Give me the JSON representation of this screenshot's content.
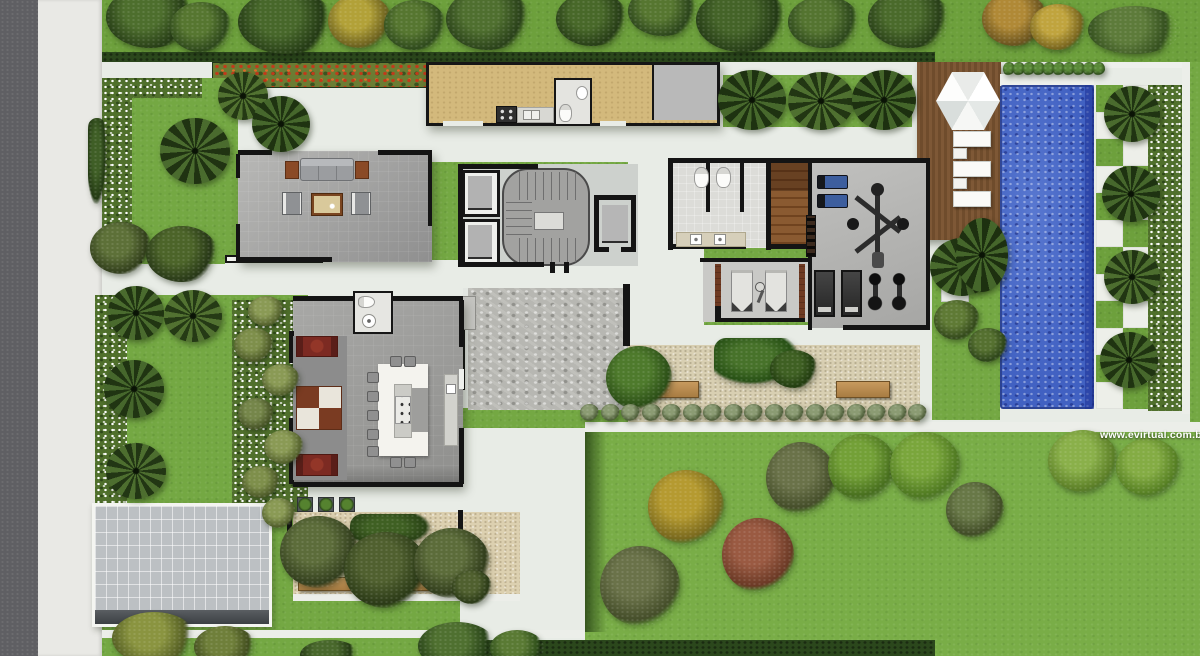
{
  "watermark": {
    "text": "www.evirtual.com.br",
    "color": "#ffffff"
  },
  "palette": {
    "grass": "#74a843",
    "grass_outer": "#6da03c",
    "street_asphalt": "#5f5f63",
    "sidewalk": "#e9e9e5",
    "walkway_white": "#e8ece6",
    "hedge": "#2b471c",
    "flower_red": "#c23a1a",
    "kitchen_floor": "#d3b97c",
    "deck_wood": "#7e5836",
    "sauna_wood": "#8a5a31",
    "pool_water": "#4161c2",
    "pool_deep_edge": "#2c49a4",
    "water_feature_gray": "#b7b7b2",
    "gravel": "#d8cfb2",
    "courtyard_sand": "#dcd0b0",
    "driveway": "#bcc0c3",
    "wall_black": "#141414",
    "sofa_red": "#7c2a22",
    "gym_bench_blue": "#3d5e9e",
    "bench_wood": "#b98b4e",
    "table_white": "#f4f3ee"
  },
  "scene": {
    "trees": [
      {
        "k": "round",
        "x": 106,
        "y": -14,
        "w": 88,
        "h": 62,
        "c1": "#4d6e2d",
        "c2": "#263c16"
      },
      {
        "k": "round",
        "x": 170,
        "y": 2,
        "w": 62,
        "h": 50,
        "c1": "#567630",
        "c2": "#2e481c"
      },
      {
        "k": "round",
        "x": 238,
        "y": -10,
        "w": 96,
        "h": 64,
        "c1": "#47672a",
        "c2": "#243a15"
      },
      {
        "k": "round",
        "x": 328,
        "y": -6,
        "w": 64,
        "h": 54,
        "c1": "#b2a138",
        "c2": "#6d6220"
      },
      {
        "k": "round",
        "x": 384,
        "y": 0,
        "w": 62,
        "h": 50,
        "c1": "#567630",
        "c2": "#2f4a1d"
      },
      {
        "k": "round",
        "x": 446,
        "y": -12,
        "w": 84,
        "h": 62,
        "c1": "#4f6f2f",
        "c2": "#2a411a"
      },
      {
        "k": "round",
        "x": 556,
        "y": -8,
        "w": 72,
        "h": 54,
        "c1": "#486829",
        "c2": "#273d17"
      },
      {
        "k": "round",
        "x": 628,
        "y": -14,
        "w": 70,
        "h": 50,
        "c1": "#567630",
        "c2": "#2c451c"
      },
      {
        "k": "round",
        "x": 696,
        "y": -12,
        "w": 92,
        "h": 64,
        "c1": "#446328",
        "c2": "#243a16"
      },
      {
        "k": "round",
        "x": 788,
        "y": -4,
        "w": 72,
        "h": 52,
        "c1": "#547430",
        "c2": "#2d471c"
      },
      {
        "k": "round",
        "x": 868,
        "y": -10,
        "w": 82,
        "h": 58,
        "c1": "#4a6a2b",
        "c2": "#283e18"
      },
      {
        "k": "round",
        "x": 982,
        "y": -8,
        "w": 66,
        "h": 54,
        "c1": "#b08936",
        "c2": "#6a5420"
      },
      {
        "k": "round",
        "x": 1030,
        "y": 4,
        "w": 56,
        "h": 46,
        "c1": "#c0a43e",
        "c2": "#78651f"
      },
      {
        "k": "round",
        "x": 1088,
        "y": 6,
        "w": 92,
        "h": 48,
        "c1": "#5d7b3a",
        "c2": "#35501f"
      },
      {
        "k": "palm",
        "x": 160,
        "y": 118,
        "w": 70,
        "h": 66,
        "c1": "#4a6b2e",
        "c2": "#203312"
      },
      {
        "k": "palm",
        "x": 218,
        "y": 72,
        "w": 50,
        "h": 48,
        "c1": "#527231",
        "c2": "#243914"
      },
      {
        "k": "palm",
        "x": 252,
        "y": 96,
        "w": 58,
        "h": 56,
        "c1": "#46672c",
        "c2": "#1f3311"
      },
      {
        "k": "hedge",
        "x": 88,
        "y": 118,
        "w": 18,
        "h": 86,
        "c1": "#3f5e26",
        "c2": "#243a14"
      },
      {
        "k": "round",
        "x": 90,
        "y": 222,
        "w": 62,
        "h": 52,
        "c1": "#5d7038",
        "c2": "#323f1c"
      },
      {
        "k": "round",
        "x": 146,
        "y": 226,
        "w": 72,
        "h": 56,
        "c1": "#4c6429",
        "c2": "#273717"
      },
      {
        "k": "palm",
        "x": 108,
        "y": 286,
        "w": 56,
        "h": 54,
        "c1": "#4a6b2e",
        "c2": "#213512"
      },
      {
        "k": "palm",
        "x": 164,
        "y": 290,
        "w": 58,
        "h": 52,
        "c1": "#527231",
        "c2": "#253a15"
      },
      {
        "k": "palm",
        "x": 104,
        "y": 360,
        "w": 60,
        "h": 58,
        "c1": "#46672c",
        "c2": "#203412"
      },
      {
        "k": "palm",
        "x": 106,
        "y": 443,
        "w": 60,
        "h": 56,
        "c1": "#4d6e2f",
        "c2": "#223614"
      },
      {
        "k": "round",
        "x": 248,
        "y": 296,
        "w": 36,
        "h": 30,
        "c1": "#8a9a55",
        "c2": "#55622e"
      },
      {
        "k": "round",
        "x": 234,
        "y": 328,
        "w": 40,
        "h": 34,
        "c1": "#7e8f4b",
        "c2": "#4c5928"
      },
      {
        "k": "round",
        "x": 262,
        "y": 364,
        "w": 38,
        "h": 32,
        "c1": "#8a9a55",
        "c2": "#515e2c"
      },
      {
        "k": "round",
        "x": 238,
        "y": 398,
        "w": 36,
        "h": 32,
        "c1": "#75864a",
        "c2": "#475427"
      },
      {
        "k": "round",
        "x": 264,
        "y": 430,
        "w": 40,
        "h": 34,
        "c1": "#8a9a55",
        "c2": "#55622e"
      },
      {
        "k": "round",
        "x": 242,
        "y": 466,
        "w": 38,
        "h": 32,
        "c1": "#7e8f4b",
        "c2": "#4c5928"
      },
      {
        "k": "round",
        "x": 262,
        "y": 498,
        "w": 34,
        "h": 30,
        "c1": "#8a9a55",
        "c2": "#515e2c"
      },
      {
        "k": "palm",
        "x": 718,
        "y": 70,
        "w": 68,
        "h": 60,
        "c1": "#47682c",
        "c2": "#1e3211"
      },
      {
        "k": "palm",
        "x": 788,
        "y": 72,
        "w": 66,
        "h": 58,
        "c1": "#4f7030",
        "c2": "#223613"
      },
      {
        "k": "palm",
        "x": 852,
        "y": 70,
        "w": 64,
        "h": 60,
        "c1": "#44652a",
        "c2": "#1d3010"
      },
      {
        "k": "palm",
        "x": 930,
        "y": 238,
        "w": 64,
        "h": 58,
        "c1": "#496a2d",
        "c2": "#203412"
      },
      {
        "k": "round",
        "x": 934,
        "y": 300,
        "w": 46,
        "h": 40,
        "c1": "#5f7a35",
        "c2": "#34491c"
      },
      {
        "k": "round",
        "x": 968,
        "y": 328,
        "w": 40,
        "h": 34,
        "c1": "#557030",
        "c2": "#2d441a"
      },
      {
        "k": "palm",
        "x": 956,
        "y": 218,
        "w": 52,
        "h": 74,
        "c1": "#45662b",
        "c2": "#1d3010"
      },
      {
        "k": "palm",
        "x": 1104,
        "y": 86,
        "w": 56,
        "h": 56,
        "c1": "#4a6b2e",
        "c2": "#203412"
      },
      {
        "k": "palm",
        "x": 1102,
        "y": 166,
        "w": 58,
        "h": 56,
        "c1": "#46672c",
        "c2": "#1e3211"
      },
      {
        "k": "palm",
        "x": 1104,
        "y": 250,
        "w": 56,
        "h": 54,
        "c1": "#4d6e2f",
        "c2": "#213513"
      },
      {
        "k": "palm",
        "x": 1100,
        "y": 332,
        "w": 58,
        "h": 56,
        "c1": "#47682c",
        "c2": "#1f3311"
      },
      {
        "k": "hedge",
        "x": 350,
        "y": 514,
        "w": 80,
        "h": 32,
        "c1": "#3f6023",
        "c2": "#2a4316"
      },
      {
        "k": "round",
        "x": 280,
        "y": 516,
        "w": 78,
        "h": 72,
        "c1": "#5c6c3a",
        "c2": "#333f1e"
      },
      {
        "k": "round",
        "x": 344,
        "y": 532,
        "w": 84,
        "h": 76,
        "c1": "#50602f",
        "c2": "#2b3a17"
      },
      {
        "k": "round",
        "x": 414,
        "y": 528,
        "w": 76,
        "h": 70,
        "c1": "#5c6c3a",
        "c2": "#323e1d"
      },
      {
        "k": "round",
        "x": 452,
        "y": 570,
        "w": 40,
        "h": 34,
        "c1": "#50602f",
        "c2": "#2b3a17"
      },
      {
        "k": "round",
        "x": 606,
        "y": 346,
        "w": 66,
        "h": 64,
        "c1": "#4e7a2c",
        "c2": "#2c4f17"
      },
      {
        "k": "hedge",
        "x": 714,
        "y": 338,
        "w": 84,
        "h": 46,
        "c1": "#47722a",
        "c2": "#275015"
      },
      {
        "k": "round",
        "x": 770,
        "y": 350,
        "w": 48,
        "h": 38,
        "c1": "#3f6023",
        "c2": "#223c10"
      },
      {
        "k": "round",
        "x": 112,
        "y": 612,
        "w": 84,
        "h": 52,
        "c1": "#8a9440",
        "c2": "#545e24"
      },
      {
        "k": "round",
        "x": 194,
        "y": 626,
        "w": 62,
        "h": 42,
        "c1": "#6f7f3a",
        "c2": "#424e1f"
      },
      {
        "k": "round",
        "x": 300,
        "y": 640,
        "w": 60,
        "h": 30,
        "c1": "#49682c",
        "c2": "#263c15"
      },
      {
        "k": "round",
        "x": 418,
        "y": 622,
        "w": 78,
        "h": 48,
        "c1": "#4f7030",
        "c2": "#2a451a"
      },
      {
        "k": "round",
        "x": 490,
        "y": 630,
        "w": 54,
        "h": 36,
        "c1": "#5a7a34",
        "c2": "#31511c"
      },
      {
        "k": "round",
        "x": 648,
        "y": 470,
        "w": 76,
        "h": 74,
        "c1": "#b59a30",
        "c2": "#79691e"
      },
      {
        "k": "round",
        "x": 722,
        "y": 518,
        "w": 72,
        "h": 74,
        "c1": "#9a5a42",
        "c2": "#6b3a26"
      },
      {
        "k": "round",
        "x": 600,
        "y": 546,
        "w": 80,
        "h": 80,
        "c1": "#6a7249",
        "c2": "#454e2a"
      },
      {
        "k": "round",
        "x": 766,
        "y": 442,
        "w": 70,
        "h": 72,
        "c1": "#6a7249",
        "c2": "#454e2a"
      },
      {
        "k": "round",
        "x": 828,
        "y": 434,
        "w": 68,
        "h": 66,
        "c1": "#73a037",
        "c2": "#49701f"
      },
      {
        "k": "round",
        "x": 890,
        "y": 432,
        "w": 70,
        "h": 68,
        "c1": "#7aa63c",
        "c2": "#507a22"
      },
      {
        "k": "round",
        "x": 946,
        "y": 482,
        "w": 58,
        "h": 56,
        "c1": "#687847",
        "c2": "#414c27"
      },
      {
        "k": "round",
        "x": 1048,
        "y": 430,
        "w": 70,
        "h": 62,
        "c1": "#8ab04a",
        "c2": "#5d8028"
      },
      {
        "k": "round",
        "x": 1116,
        "y": 438,
        "w": 64,
        "h": 58,
        "c1": "#84ac44",
        "c2": "#578024"
      }
    ],
    "bush_row": {
      "x0": 580,
      "y": 404,
      "dx": 20.5,
      "count": 17,
      "w": 19,
      "h": 17,
      "c1": "#8b9b73",
      "c2": "#4d5d38"
    },
    "pool_shrub_row": {
      "x0": 1003,
      "y": 62,
      "dx": 10,
      "count": 10,
      "w": 12,
      "h": 14,
      "c1": "#5a8a38",
      "c2": "#2e4d1a"
    },
    "checkerboard": {
      "x": 1096,
      "y": 85,
      "size": 27,
      "cols": 2,
      "rows": 12,
      "parity": 1
    },
    "loungers": [
      {
        "x": 953,
        "y": 131
      },
      {
        "x": 953,
        "y": 161
      },
      {
        "x": 953,
        "y": 191
      }
    ],
    "lounger_tables": [
      {
        "x": 953,
        "y": 148
      },
      {
        "x": 953,
        "y": 178
      }
    ],
    "dining_chairs": [
      [
        390,
        356
      ],
      [
        404,
        356
      ],
      [
        367,
        372
      ],
      [
        367,
        391
      ],
      [
        367,
        410
      ],
      [
        367,
        429
      ],
      [
        367,
        446
      ],
      [
        390,
        457
      ],
      [
        404,
        457
      ]
    ],
    "planters": {
      "y": 497,
      "xs": [
        297,
        318,
        339
      ]
    }
  }
}
